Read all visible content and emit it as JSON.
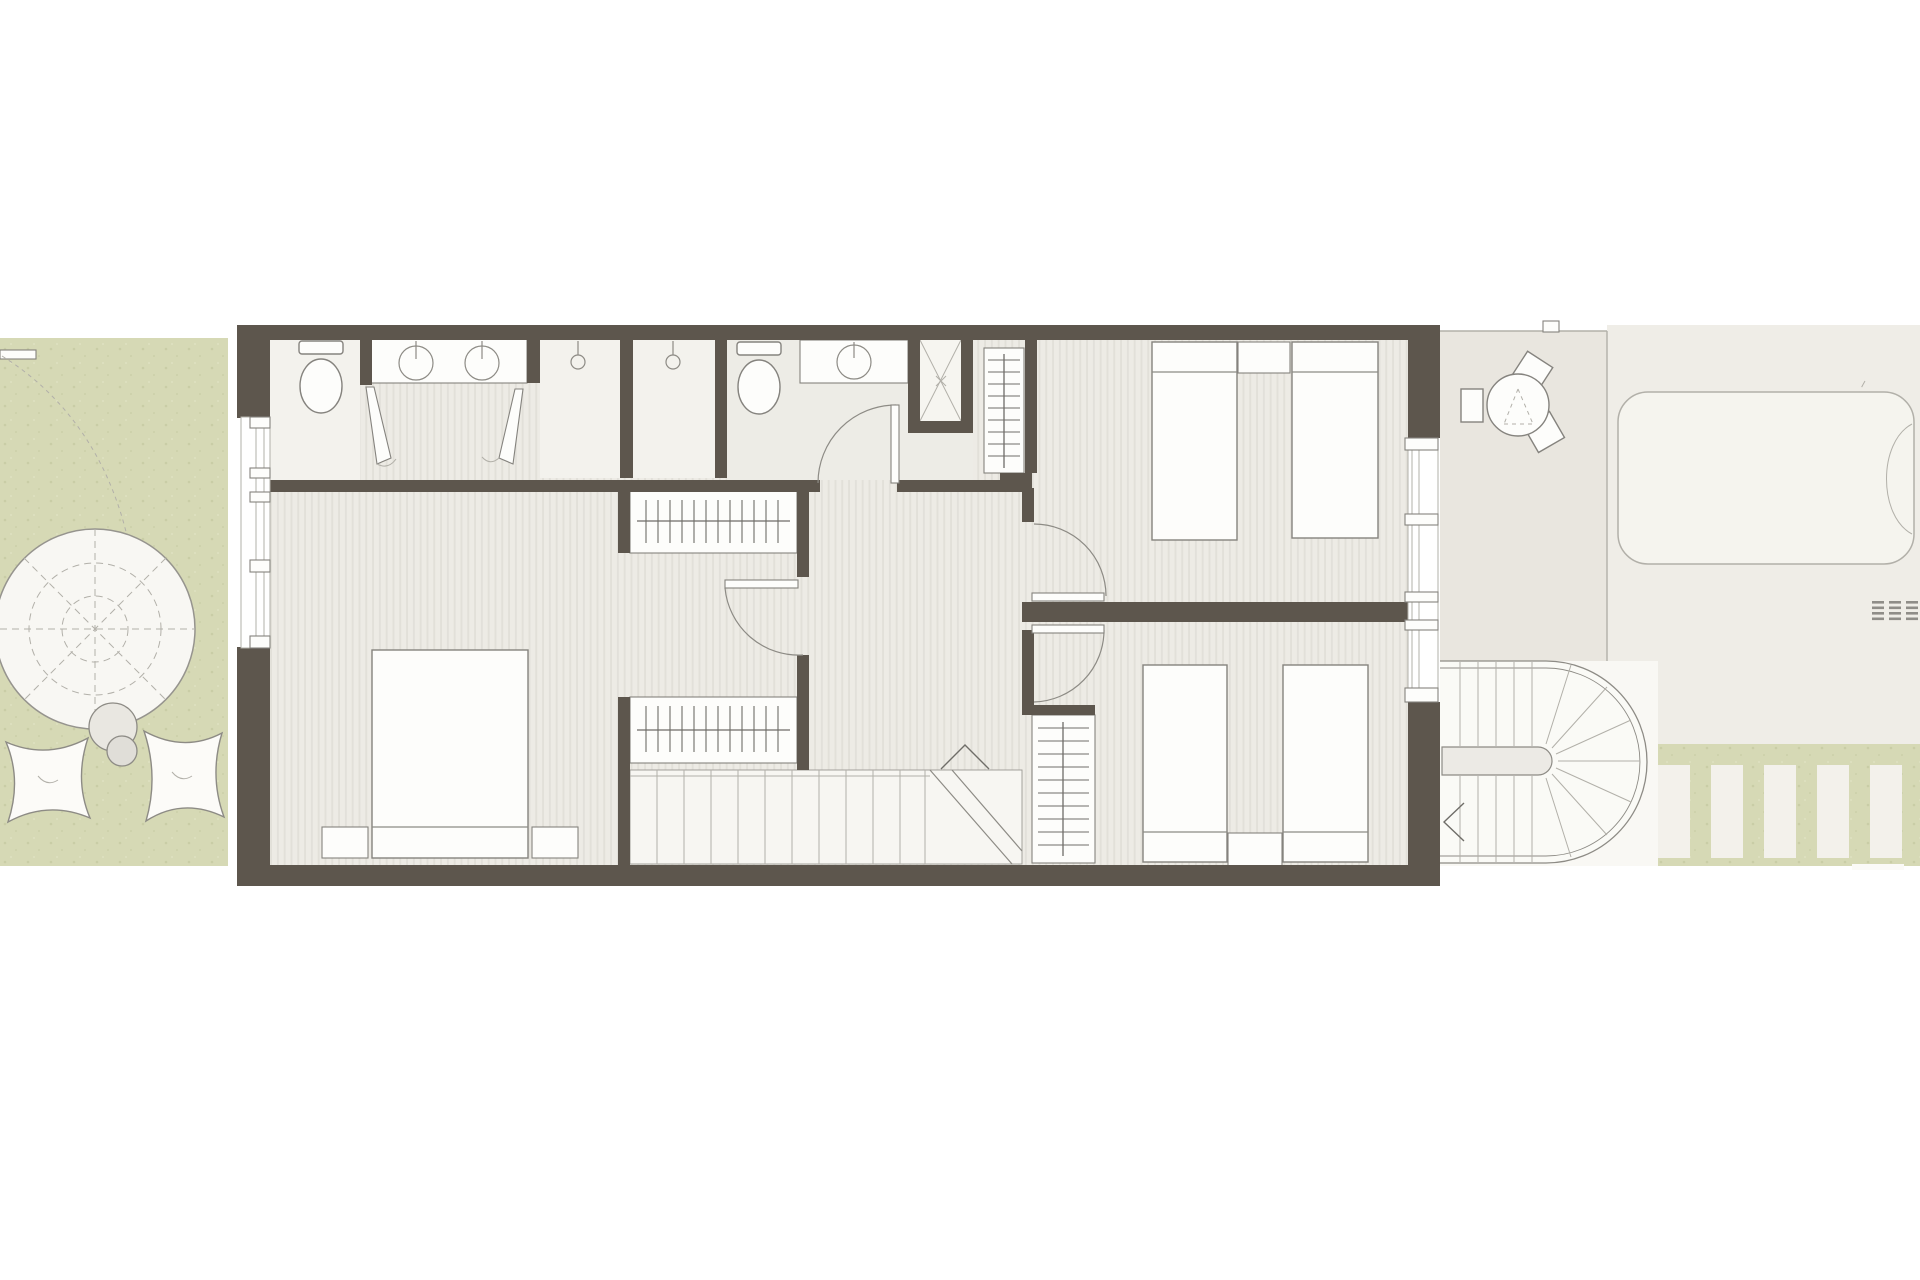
{
  "canvas": {
    "width": 1920,
    "height": 1280,
    "background": "#ffffff"
  },
  "drawing_type": "residential-upper-floor-plan",
  "colors": {
    "wall": "#5d564d",
    "floor_base": "#edebe5",
    "floor_stripe": "#e2e0d9",
    "bath_floor": "#f3f2ed",
    "bath2_floor": "#edece6",
    "terrace": "#e9e6df",
    "pool_deck": "#efede7",
    "pool": "#f5f4ee",
    "garden": "#d6d9b5",
    "speckle": "#c3c8a0",
    "stair_zone": "#f9f8f4",
    "paver": "#f3f1eb",
    "white": "#fdfdfb",
    "soft": "#f0efe9",
    "outline": "#85837e",
    "line_light": "#b2b0a9",
    "line_mid": "#8d8b85",
    "ink": "#6f6d68",
    "grate": "#8f8d88"
  },
  "legend": {
    "indoor_areas": [
      "wc",
      "master-bathroom",
      "dressing-vanity-area",
      "shower",
      "shower",
      "bathroom-2",
      "service-shaft",
      "hallway",
      "master-bedroom",
      "dressing-alcove",
      "bedroom-2",
      "bedroom-3",
      "staircase"
    ],
    "outdoor_areas": [
      "garden",
      "terrace",
      "pool-deck",
      "spiral-staircase",
      "stepping-stone-path"
    ],
    "fixtures": {
      "toilet": 2,
      "sink": 3,
      "shower_head": 2,
      "wardrobe": 4,
      "double_bed": 1,
      "single_bed": 4,
      "nightstand": 4,
      "round_table": 1,
      "chair": 3,
      "parasol": 1,
      "pouf": 2,
      "side_table": 2,
      "pool": 1,
      "drain_grate": 1,
      "stepping_stone": 5
    }
  }
}
